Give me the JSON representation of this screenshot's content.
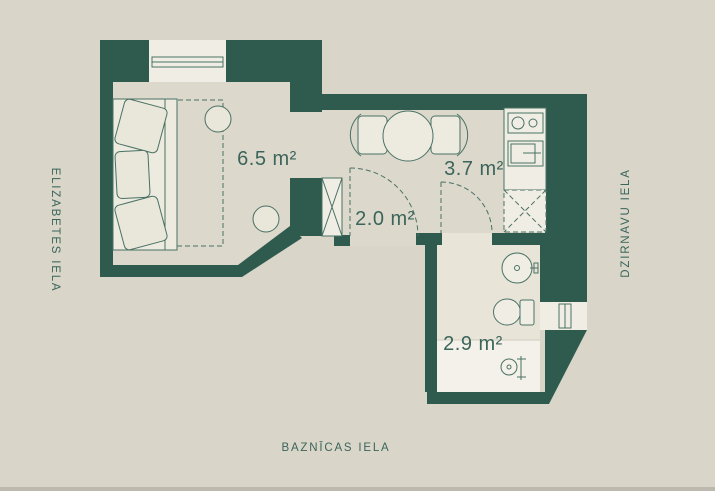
{
  "plan": {
    "title_context": "apartment floor plan",
    "streets": {
      "left": "ELIZABETES IELA",
      "right": "DZIRNAVU IELA",
      "bottom": "BAZNĪCAS IELA"
    },
    "rooms": [
      {
        "name": "living-room",
        "label": "6.5 m²"
      },
      {
        "name": "hallway",
        "label": "2.0 m²"
      },
      {
        "name": "kitchen",
        "label": "3.7 m²"
      },
      {
        "name": "bathroom",
        "label": "2.9 m²"
      }
    ],
    "colors": {
      "wall": "#2f5b4f",
      "bg": "#d9d5c9",
      "floor": "#dcd8cc",
      "bath_floor": "#e8e4d8",
      "shower_floor": "#f3f1e9",
      "white": "#f0eee4",
      "furniture": "#edebe0",
      "furniture_alt": "#e9e6da",
      "line": "#4a7164",
      "text": "#3b655a",
      "edge": "#bdb9ae"
    }
  }
}
